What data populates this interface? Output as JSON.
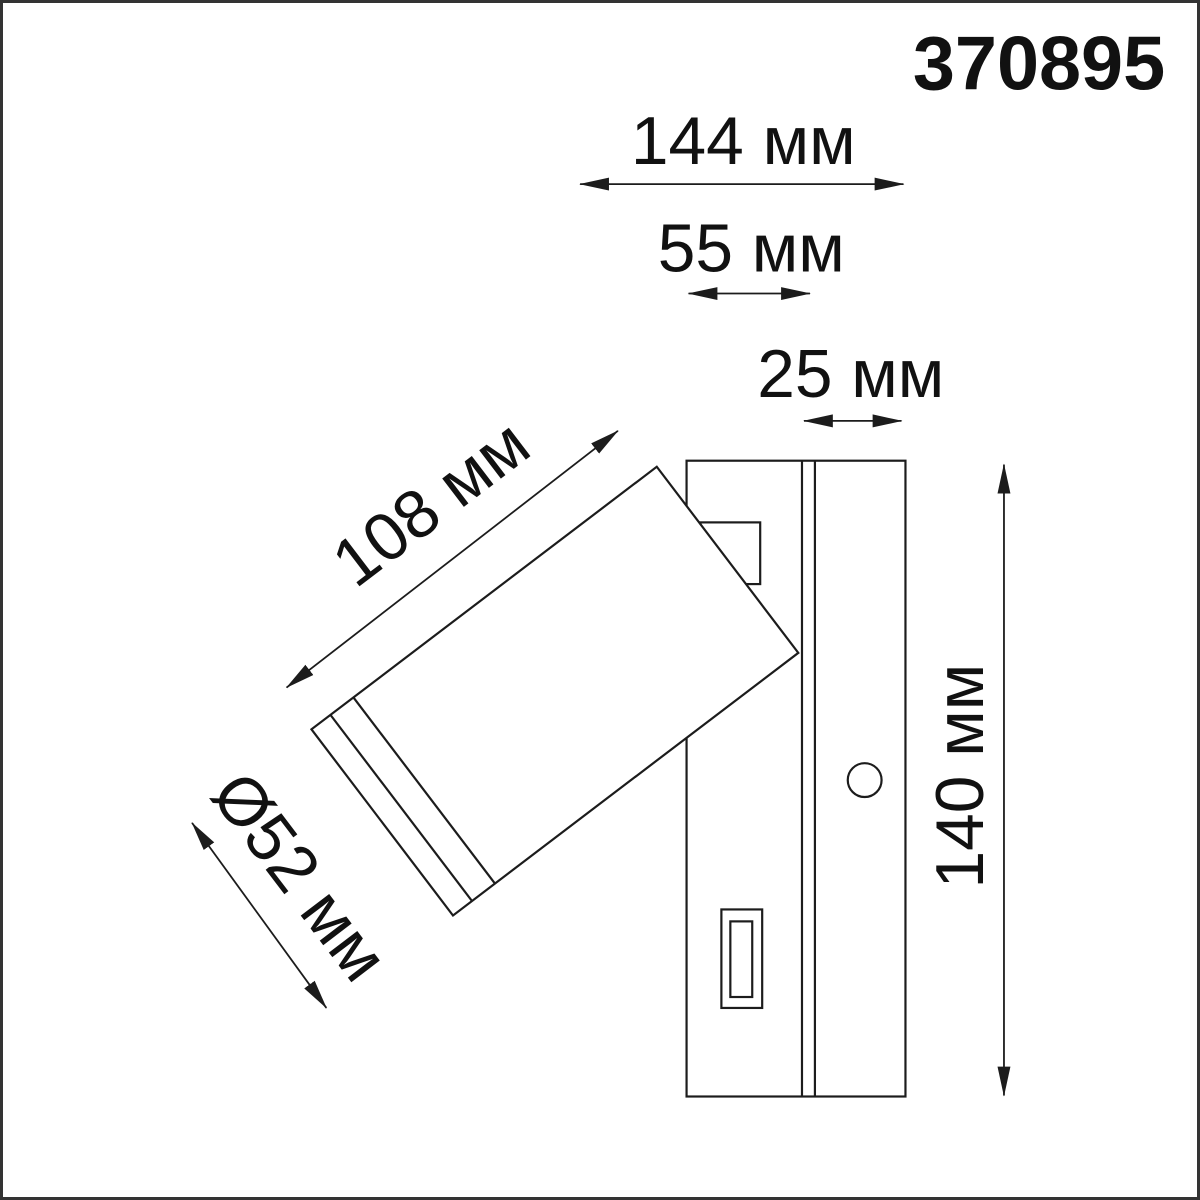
{
  "product": {
    "code": "370895"
  },
  "dimensions": {
    "total_depth": {
      "label": "144 мм"
    },
    "body_depth": {
      "label": "55 мм"
    },
    "plate_depth": {
      "label": "25 мм"
    },
    "head_length": {
      "label": "108 мм"
    },
    "head_diameter": {
      "label": "Ø52 мм"
    },
    "height": {
      "label": "140 мм"
    }
  }
}
